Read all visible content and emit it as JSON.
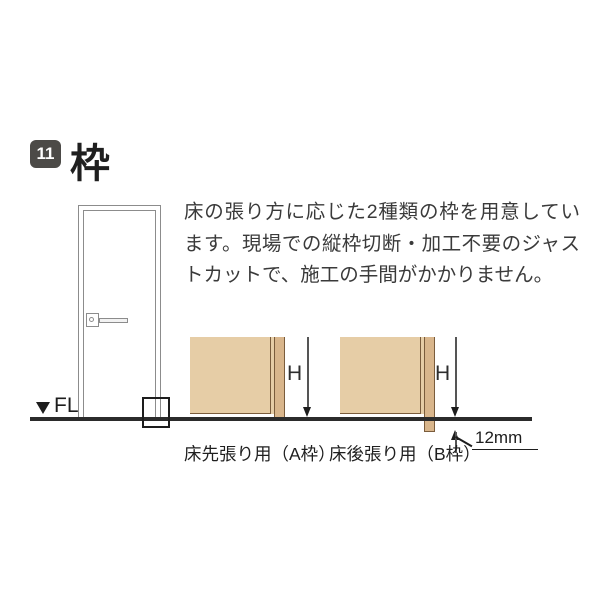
{
  "header": {
    "badge": "11",
    "title": "枠"
  },
  "intro": {
    "text": "床の張り方に応じた2種類の枠を用意しています。現場での縦枠切断・加工不要のジャストカットで、施工の手間がかかりません。"
  },
  "figure": {
    "fl_label": "FL",
    "frame_a": {
      "caption": "床先張り用（A枠）",
      "height_label": "H"
    },
    "frame_b": {
      "caption": "床後張り用（B枠）",
      "height_label": "H",
      "offset_label": "12mm"
    }
  },
  "colors": {
    "badge_bg": "#4c4a47",
    "wall_fill": "#e6cda6",
    "frame_fill": "#d9b68c",
    "edge_line": "#7a5c3c",
    "floor_line": "#2b2b2b",
    "door_line": "#8c8c8c",
    "text": "#3a3a3a"
  }
}
